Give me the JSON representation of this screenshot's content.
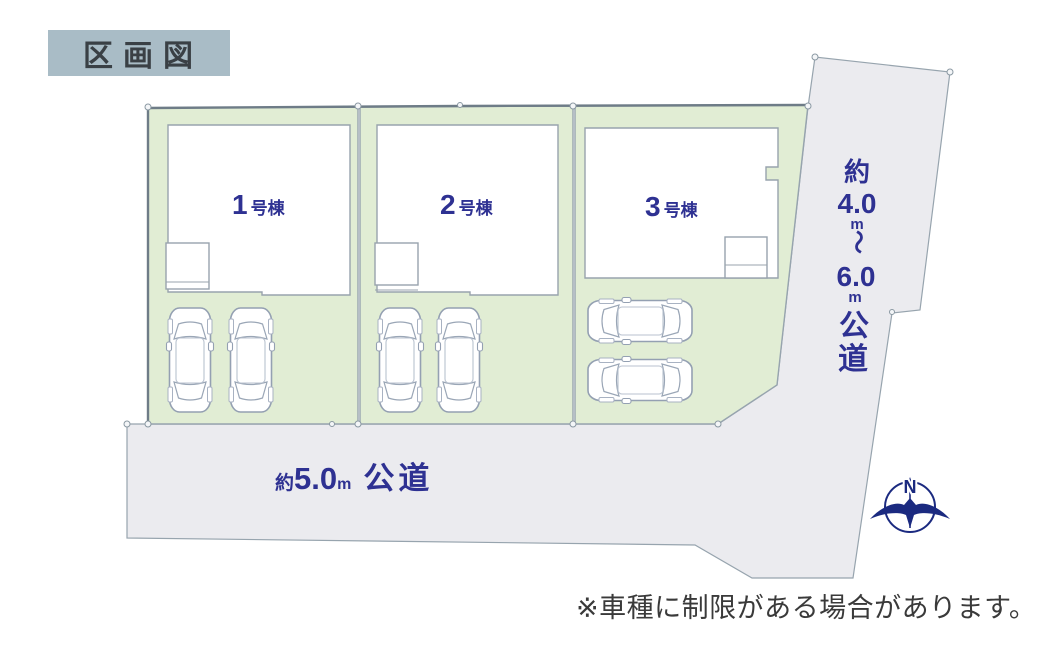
{
  "title": "区画図",
  "lots": [
    {
      "number": "1",
      "suffix": "号棟"
    },
    {
      "number": "2",
      "suffix": "号棟"
    },
    {
      "number": "3",
      "suffix": "号棟"
    }
  ],
  "roads": {
    "right_vertical": {
      "full_label": "約4.0m〜6.0m公道",
      "label_lines": [
        "約",
        "4.0",
        "m",
        "〜",
        "6.0",
        "m",
        "公",
        "道"
      ]
    },
    "bottom": {
      "full_label": "約5.0m 公道",
      "prefix": "約",
      "width_value": "5.0",
      "unit": "m",
      "name": "公道"
    }
  },
  "compass": {
    "north_label": "N"
  },
  "note": "※車種に制限がある場合があります。",
  "colors": {
    "accent_navy": "#2e3192",
    "compass_navy": "#1b2a80",
    "parcel_green": "#e1edd4",
    "road_gray": "#ebebef",
    "boundary_gray": "#97a4ae",
    "dark_boundary": "#6e7c87",
    "title_bg": "#a9bcc6",
    "title_text": "#3a4045",
    "note_text": "#3a3a3a"
  }
}
